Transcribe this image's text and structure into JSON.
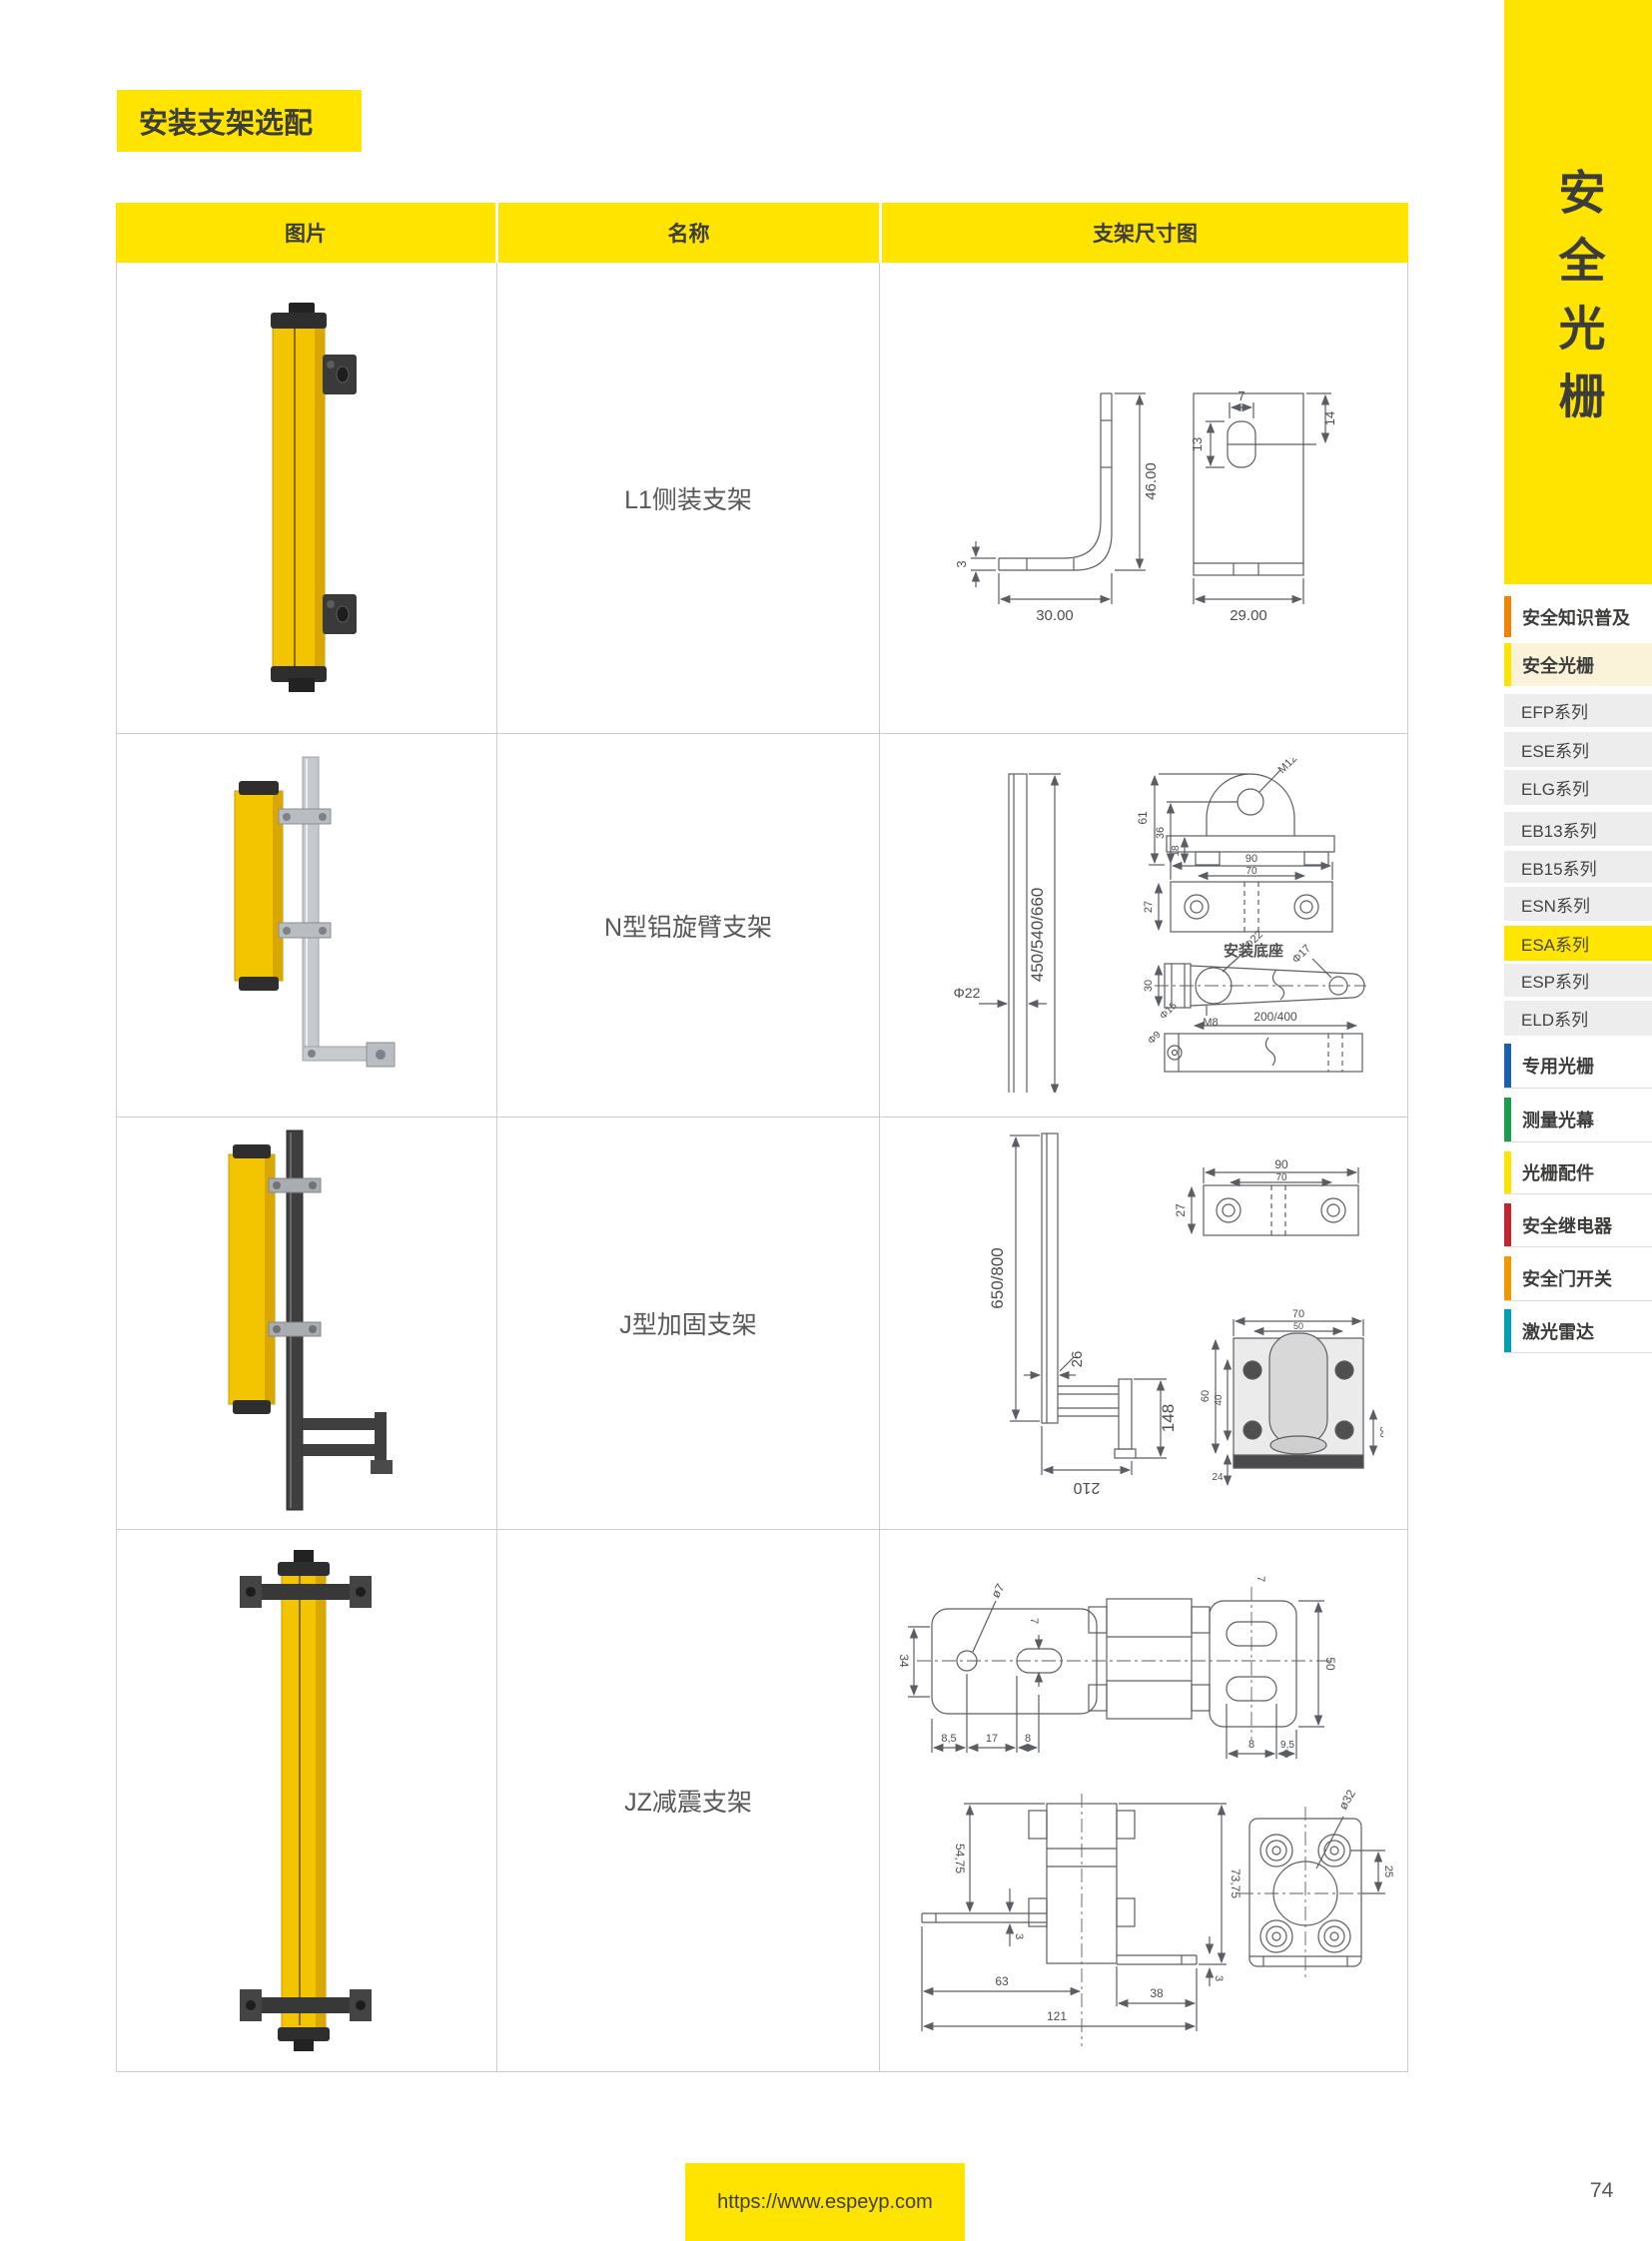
{
  "page": {
    "title": "安装支架选配",
    "page_number": "74",
    "footer_url": "https://www.espeyp.com",
    "accent_yellow": "#FFE400"
  },
  "sidebar": {
    "vertical_title": "安全光栅",
    "top_sections": [
      {
        "label": "安全知识普及",
        "bar_color": "#F08300",
        "bg": "#FFFFFF"
      },
      {
        "label": "安全光栅",
        "bar_color": "#FFE400",
        "bg": "#FAF3DA"
      }
    ],
    "series": [
      {
        "label": "EFP系列"
      },
      {
        "label": "ESE系列"
      },
      {
        "label": "ELG系列"
      },
      {
        "label": "EB13系列"
      },
      {
        "label": "EB15系列"
      },
      {
        "label": "ESN系列"
      },
      {
        "label": "ESA系列",
        "active": true,
        "active_bg": "#FFE600"
      },
      {
        "label": "ESP系列"
      },
      {
        "label": "ELD系列"
      }
    ],
    "bottom_sections": [
      {
        "label": "专用光栅",
        "bar_color": "#1961AC"
      },
      {
        "label": "测量光幕",
        "bar_color": "#199E50"
      },
      {
        "label": "光栅配件",
        "bar_color": "#FFE400"
      },
      {
        "label": "安全继电器",
        "bar_color": "#C2272D"
      },
      {
        "label": "安全门开关",
        "bar_color": "#F39800"
      },
      {
        "label": "激光雷达",
        "bar_color": "#00A0B4"
      }
    ]
  },
  "table": {
    "headers": [
      "图片",
      "名称",
      "支架尺寸图"
    ],
    "rows": [
      {
        "name": "L1侧装支架",
        "dims": [
          "46.00",
          "30.00",
          "3",
          "7",
          "13",
          "14",
          "29.00"
        ]
      },
      {
        "name": "N型铝旋臂支架",
        "dims": [
          "450/540/660",
          "Φ22",
          "M12",
          "61",
          "36",
          "18",
          "90",
          "70",
          "27",
          "安装底座",
          "Φ22",
          "Φ17",
          "M8",
          "30",
          "Φ15",
          "Φ9",
          "200/400"
        ]
      },
      {
        "name": "J型加固支架",
        "dims": [
          "650/800",
          "26",
          "148",
          "210",
          "90",
          "70",
          "27",
          "70",
          "50",
          "60",
          "40",
          "30",
          "24"
        ]
      },
      {
        "name": "JZ减震支架",
        "dims": [
          "ø7",
          "7",
          "34",
          "8,5",
          "17",
          "8",
          "7",
          "50",
          "8",
          "9,5",
          "54,75",
          "3",
          "63",
          "121",
          "38",
          "3",
          "73,75",
          "ø32",
          "25"
        ]
      }
    ]
  }
}
